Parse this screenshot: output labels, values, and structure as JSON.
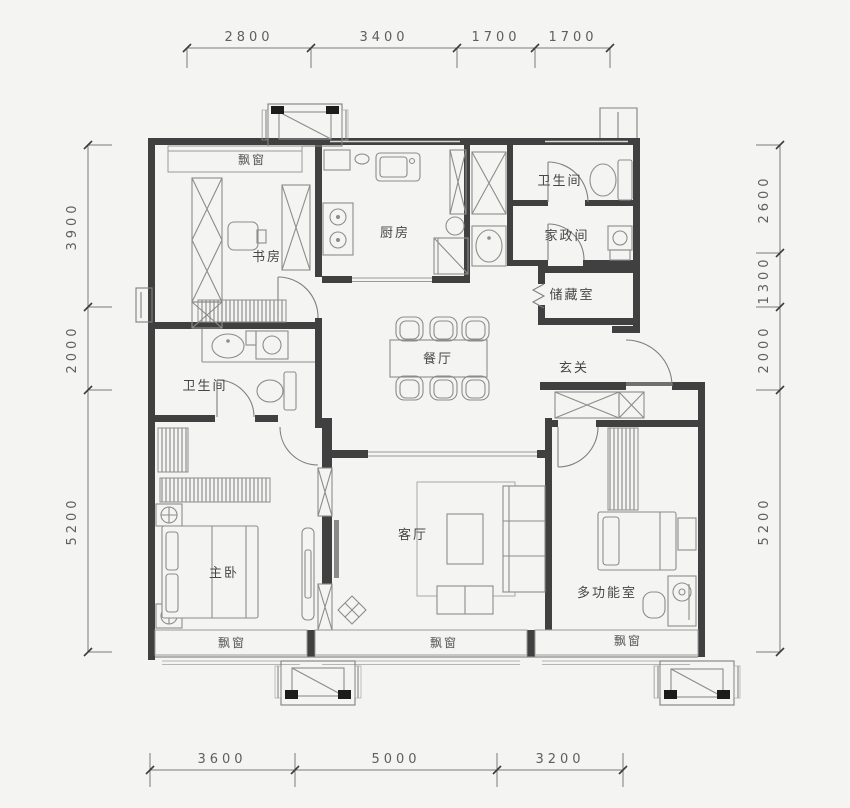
{
  "plan_type": "residential-floor-plan",
  "colors": {
    "background": "#f4f4f2",
    "wall": "#404040",
    "thin_line": "#9a9a9a",
    "dim_text": "#5f5f5f",
    "label_text": "#474747"
  },
  "dimensions": {
    "top": [
      "2800",
      "3400",
      "1700",
      "1700"
    ],
    "left": [
      "3900",
      "2000",
      "5200"
    ],
    "right": [
      "2600",
      "1300",
      "2000",
      "5200"
    ],
    "bottom": [
      "3600",
      "5000",
      "3200"
    ]
  },
  "rooms": {
    "study": "书房",
    "kitchen": "厨房",
    "bathroom_top": "卫生间",
    "housekeeping": "家政间",
    "storage": "储藏室",
    "dining": "餐厅",
    "foyer": "玄关",
    "bathroom_master": "卫生间",
    "master_bedroom": "主卧",
    "living_room": "客厅",
    "multi_function": "多功能室"
  },
  "bays": {
    "study": "飘窗",
    "master": "飘窗",
    "living": "飘窗",
    "multi": "飘窗"
  }
}
